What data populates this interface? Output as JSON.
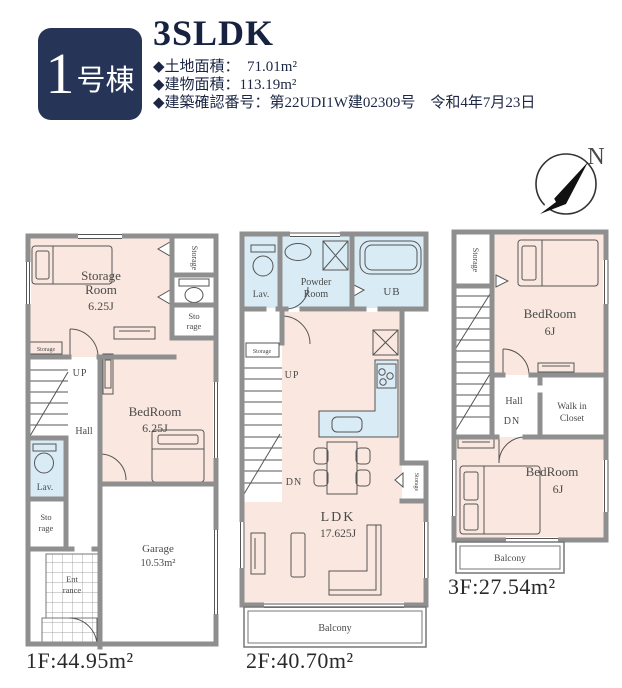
{
  "header": {
    "badge_number": "1",
    "badge_suffix": "号棟",
    "title": "3SLDK",
    "bullets": [
      "◆土地面積：　71.01m²",
      "◆建物面積：113.19m²",
      "◆建築確認番号：第22UDI1W建02309号　令和4年7月23日"
    ]
  },
  "compass": {
    "north_label": "N"
  },
  "floor1": {
    "rooms": {
      "storage_room_l1": "Storage",
      "storage_room_l2": "Room",
      "storage_room_size": "6.25J",
      "storage_top_right": "Storage",
      "storage_right_l1": "Sto",
      "storage_right_l2": "rage",
      "storage_left_small": "Storage",
      "bedroom_label": "BedRoom",
      "bedroom_size": "6.25J",
      "up": "UP",
      "hall": "Hall",
      "lav": "Lav.",
      "storage_lower_l1": "Sto",
      "storage_lower_l2": "rage",
      "entrance_l1": "Ent",
      "entrance_l2": "rance",
      "garage_label": "Garage",
      "garage_size": "10.53m²"
    },
    "area_label": "1F:44.95m²"
  },
  "floor2": {
    "rooms": {
      "lav": "Lav.",
      "powder_l1": "Powder",
      "powder_l2": "Room",
      "ub": "UB",
      "storage_small": "Storage",
      "up": "UP",
      "dn": "DN",
      "ldk_label": "LDK",
      "ldk_size": "17.625J",
      "storage_right": "Storage",
      "balcony": "Balcony"
    },
    "area_label": "2F:40.70m²"
  },
  "floor3": {
    "rooms": {
      "storage": "Storage",
      "bedroom_top_label": "BedRoom",
      "bedroom_top_size": "6J",
      "hall": "Hall",
      "dn": "DN",
      "wic_l1": "Walk in",
      "wic_l2": "Closet",
      "bedroom_bottom_label": "BedRoom",
      "bedroom_bottom_size": "6J",
      "balcony": "Balcony"
    },
    "area_label": "3F:27.54m²"
  },
  "colors": {
    "badge_bg": "#263457",
    "room_pink": "#fae8e0",
    "room_blue": "#d9ecf5",
    "wall_gray": "#8f8f8f",
    "line_dark": "#555555"
  }
}
